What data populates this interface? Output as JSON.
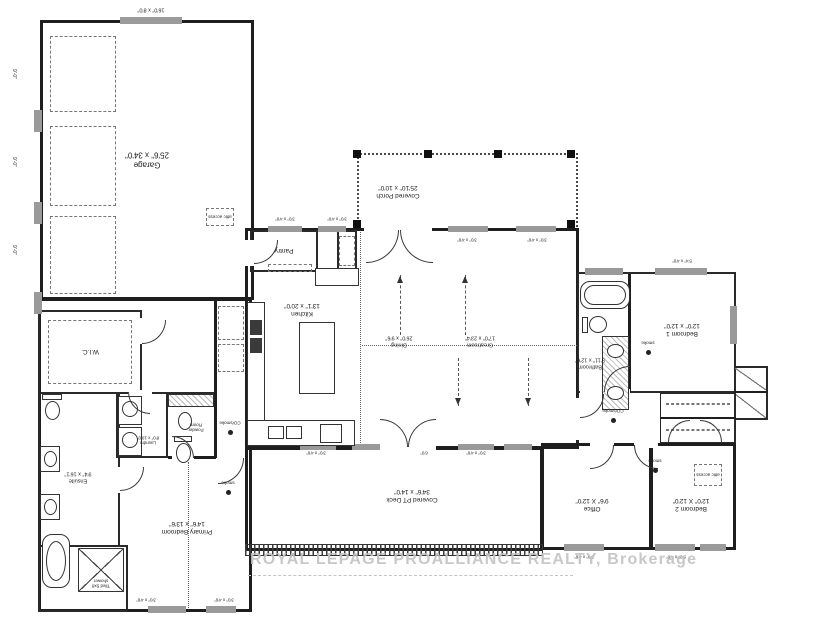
{
  "watermark": "ROYAL LEPAGE PROALLIANCE REALTY, Brokerage",
  "rooms": {
    "garage": {
      "name": "Garage",
      "dims": "25'6\" x 34'0\""
    },
    "covered_porch": {
      "name": "Covered Porch",
      "dims": "25'10\" x 10'0\""
    },
    "pantry": {
      "name": "Pantry"
    },
    "kitchen": {
      "name": "Kitchen",
      "dims": "13'1\" x 20'0\""
    },
    "dining": {
      "name": "Dining",
      "dims": "26'0\" x 9'6\""
    },
    "greatroom": {
      "name": "Greatroom",
      "dims": "17'0\" x 23'4\""
    },
    "bedroom1": {
      "name": "Bedroom 1",
      "dims": "12'0\" x 12'0\""
    },
    "bathroom": {
      "name": "Bathroom",
      "dims": "5'11\" x 12'6\""
    },
    "office": {
      "name": "Office",
      "dims": "9'6\" X 12'0\""
    },
    "bedroom2": {
      "name": "Bedroom 2",
      "dims": "12'0\" X 12'0\""
    },
    "covered_deck": {
      "name": "Covered PT Deck",
      "dims": "34'6\" x 14'0\""
    },
    "primary_bedroom": {
      "name": "Primary Bedroom",
      "dims": "14'6\" x 13'6\""
    },
    "ensuite": {
      "name": "Ensuite",
      "dims": "9'4\" x 16'1\""
    },
    "wic": {
      "name": "W.I.C."
    },
    "laundry": {
      "name": "Laundry",
      "dims": "8'0\" x 10'0\""
    },
    "powder": {
      "name": "Powder Room"
    }
  },
  "annotations": {
    "attic_access": "attic access",
    "garage_door": "16'0\" x 8'0\"",
    "side_dim": "9'-0\"",
    "window_3x4": "3'0\" x 4'0\"",
    "window_3x46": "3'0\" x 4'6\"",
    "window_54x4": "5'4\" x 4'0\"",
    "window_5x46": "5'0\" x 4'6\"",
    "door_6": "6'0\"",
    "shower": "Tiled 5x8 shower",
    "smoke": "smoke",
    "co_smoke": "CO/smoke"
  }
}
